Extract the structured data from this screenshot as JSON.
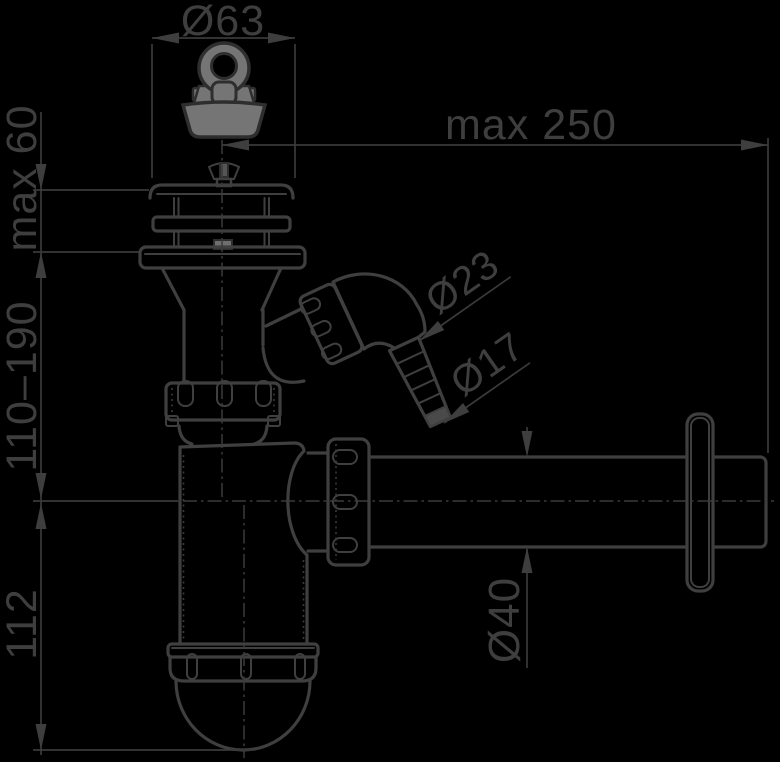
{
  "drawing": {
    "canvas": {
      "width": 780,
      "height": 762,
      "background": "#000000"
    },
    "colors": {
      "line": "#3f3f3f",
      "text": "#3e3e3e",
      "part_outline": "#2e2e2e",
      "plug_fill": "#757575",
      "seat_fill": "#6e6e6e",
      "slot_fill": "#555555",
      "hose_tip_fill": "#4a4a4a"
    },
    "labels": {
      "strainer_diameter": "Ø63",
      "wall_distance_max": "max 250",
      "deck_thickness_max": "max 60",
      "height_adjust_range": "110–190",
      "trap_depth": "112",
      "hose_connector_od": "Ø23",
      "hose_tip_od": "Ø17",
      "outlet_pipe_diameter": "Ø40"
    }
  }
}
